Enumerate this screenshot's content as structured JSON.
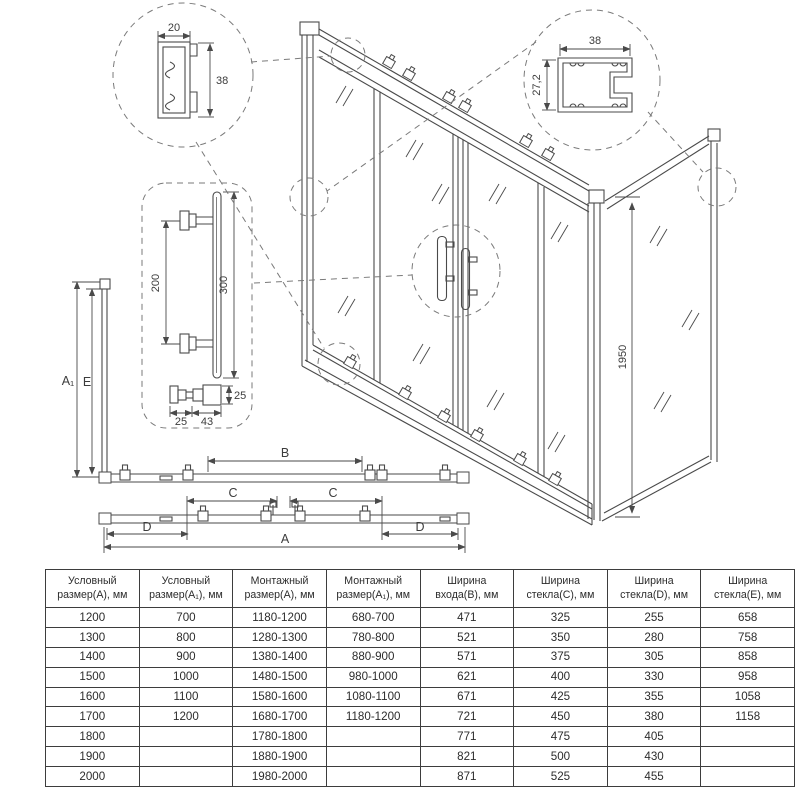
{
  "drawing": {
    "top_detail": {
      "width": "20",
      "height": "38"
    },
    "wall_detail": {
      "width": "38",
      "depth": "27,2"
    },
    "handle_detail": {
      "spacing": "200",
      "length": "300",
      "knob_depth": "25",
      "knob_w": "25",
      "knob_len": "43"
    },
    "dims": {
      "A": "A",
      "A1": "A₁",
      "B": "B",
      "C": "C",
      "D": "D",
      "E": "E",
      "height": "1950"
    }
  },
  "table": {
    "headers": [
      "Условный\nразмер(А), мм",
      "Условный\nразмер(А₁), мм",
      "Монтажный\nразмер(А), мм",
      "Монтажный\nразмер(А₁), мм",
      "Ширина\nвхода(В), мм",
      "Ширина\nстекла(С), мм",
      "Ширина\nстекла(D), мм",
      "Ширина\nстекла(Е), мм"
    ],
    "rows": [
      [
        "1200",
        "700",
        "1180-1200",
        "680-700",
        "471",
        "325",
        "255",
        "658"
      ],
      [
        "1300",
        "800",
        "1280-1300",
        "780-800",
        "521",
        "350",
        "280",
        "758"
      ],
      [
        "1400",
        "900",
        "1380-1400",
        "880-900",
        "571",
        "375",
        "305",
        "858"
      ],
      [
        "1500",
        "1000",
        "1480-1500",
        "980-1000",
        "621",
        "400",
        "330",
        "958"
      ],
      [
        "1600",
        "1100",
        "1580-1600",
        "1080-1100",
        "671",
        "425",
        "355",
        "1058"
      ],
      [
        "1700",
        "1200",
        "1680-1700",
        "1180-1200",
        "721",
        "450",
        "380",
        "1158"
      ],
      [
        "1800",
        "",
        "1780-1800",
        "",
        "771",
        "475",
        "405",
        ""
      ],
      [
        "1900",
        "",
        "1880-1900",
        "",
        "821",
        "500",
        "430",
        ""
      ],
      [
        "2000",
        "",
        "1980-2000",
        "",
        "871",
        "525",
        "455",
        ""
      ]
    ]
  }
}
